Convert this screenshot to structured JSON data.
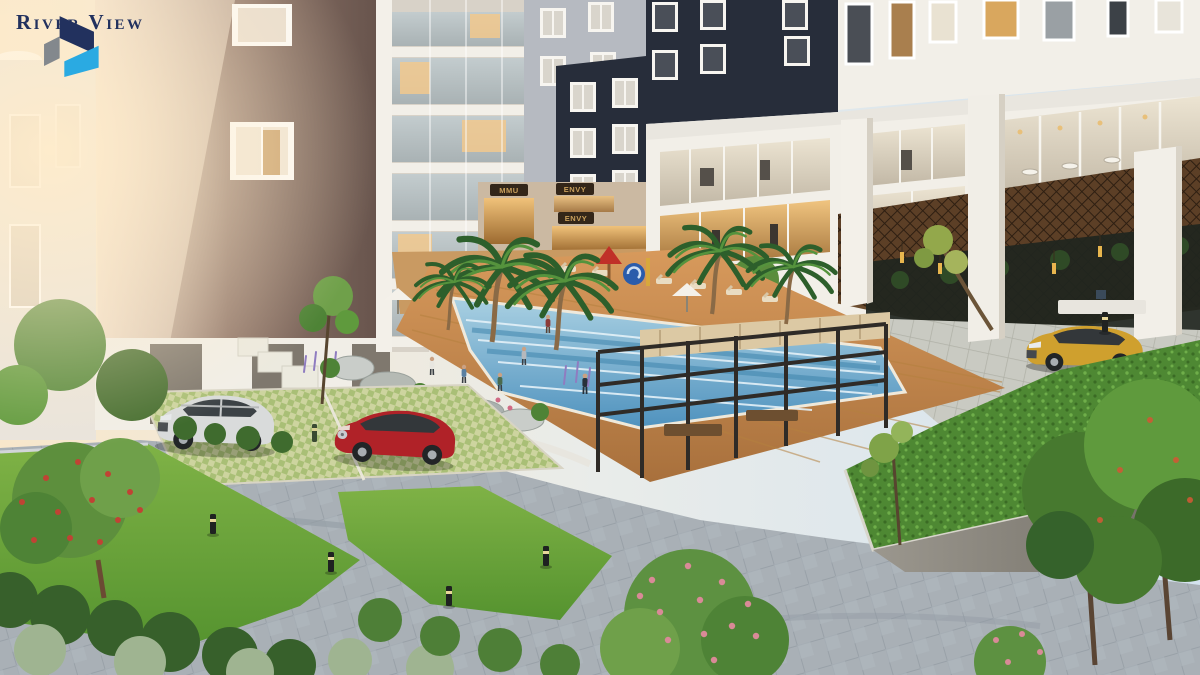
{
  "logo": {
    "text": "River View"
  },
  "signs": {
    "shop_left": "MMU",
    "shop_right_upper": "ENVY",
    "shop_right_lower": "ENVY"
  },
  "colors": {
    "brand_navy": "#22315e",
    "brand_cyan": "#2aaae2",
    "brand_gray": "#83888d",
    "building_navy": "#272d3a",
    "building_taupe": "#705c52",
    "facade_white": "#f2efe8",
    "pool_blue": "#5596c2",
    "pool_light": "#a9d0e2",
    "deck_wood": "#c08a52",
    "lawn_green": "#6aa33c",
    "hedge_green": "#3a652c",
    "road_gray": "#a9b0b6",
    "paver_light": "#c9cac2",
    "canopy_brown": "#5c3f26",
    "sign_board": "#332619",
    "sign_text": "#c9a05c",
    "car_silver": "#d9dbdb",
    "car_red": "#b02228",
    "car_gold": "#cfa02e",
    "flower_pink": "#d98a97",
    "flower_red": "#c04334",
    "lit_window": "#e8b966"
  }
}
